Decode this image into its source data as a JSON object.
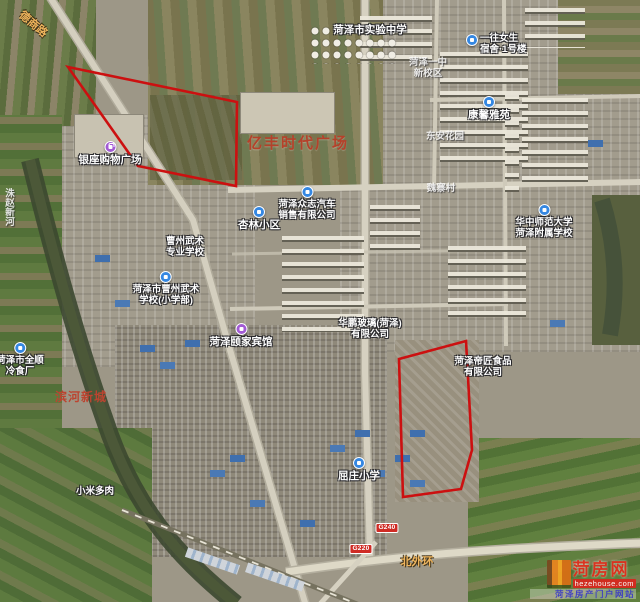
{
  "map": {
    "type": "satellite",
    "city": "菏泽",
    "plot_style": {
      "stroke": "#cc1010",
      "stroke_width": 2.6
    }
  },
  "labels": [
    {
      "name": "shiyan-middle-school",
      "lines": [
        "菏泽市实验中学"
      ],
      "x": 370,
      "y": 24,
      "cls": "lw",
      "interactable": true
    },
    {
      "name": "dorm-building",
      "lines": [
        "一往女生",
        "宿舍·1号楼"
      ],
      "x": 466,
      "y": 33,
      "cls": "lw sm",
      "icon": "blue",
      "iconPos": "left",
      "align": "left",
      "interactable": true
    },
    {
      "name": "heze-no1-middle-school",
      "lines": [
        "菏泽一中",
        "新校区"
      ],
      "x": 428,
      "y": 57,
      "cls": "lf",
      "interactable": true
    },
    {
      "name": "kangxin-yayuan",
      "lines": [
        "康馨雅苑"
      ],
      "x": 489,
      "y": 96,
      "cls": "lw",
      "icon": "blue",
      "iconPos": "top",
      "interactable": true
    },
    {
      "name": "dongan-garden",
      "lines": [
        "东安花园"
      ],
      "x": 445,
      "y": 131,
      "cls": "lf",
      "interactable": true
    },
    {
      "name": "yifeng-times-plaza",
      "lines": [
        "亿丰时代广场"
      ],
      "x": 298,
      "y": 132,
      "cls": "lr-lg",
      "interactable": true
    },
    {
      "name": "yinzuo-shopping-plaza",
      "lines": [
        "银座购物广场"
      ],
      "x": 110,
      "y": 141,
      "cls": "lw",
      "icon": "purple-shop",
      "iconPos": "top",
      "interactable": true
    },
    {
      "name": "zhongzhi-auto-sales",
      "lines": [
        "菏泽众志汽车",
        "销售有限公司"
      ],
      "x": 307,
      "y": 186,
      "cls": "lw sm",
      "icon": "blue",
      "iconPos": "top",
      "interactable": true
    },
    {
      "name": "xinglin-residential",
      "lines": [
        "杏林小区"
      ],
      "x": 259,
      "y": 206,
      "cls": "lw",
      "icon": "blue",
      "iconPos": "top",
      "interactable": true
    },
    {
      "name": "caozhou-martial-arts-school",
      "lines": [
        "曹州武术",
        "专业学校"
      ],
      "x": 185,
      "y": 236,
      "cls": "lw sm",
      "interactable": true
    },
    {
      "name": "martial-arts-primary-school",
      "lines": [
        "菏泽市曹州武术",
        "学校(小学部)"
      ],
      "x": 166,
      "y": 271,
      "cls": "lw sm",
      "icon": "blue",
      "iconPos": "top",
      "interactable": true
    },
    {
      "name": "weizhai-village",
      "lines": [
        "魏寨村"
      ],
      "x": 441,
      "y": 183,
      "cls": "lf",
      "interactable": false
    },
    {
      "name": "huazhong-normal-univ-affiliated-school",
      "lines": [
        "华中师范大学",
        "菏泽附属学校"
      ],
      "x": 544,
      "y": 204,
      "cls": "lw sm",
      "icon": "blue",
      "iconPos": "top",
      "interactable": true
    },
    {
      "name": "huapeng-glass-co",
      "lines": [
        "华鹏玻璃(菏泽)",
        "有限公司"
      ],
      "x": 370,
      "y": 318,
      "cls": "lw sm",
      "interactable": true
    },
    {
      "name": "yijia-hotel",
      "lines": [
        "菏泽颐家宾馆"
      ],
      "x": 241,
      "y": 323,
      "cls": "lw",
      "icon": "purple-hotel",
      "iconPos": "top",
      "interactable": true
    },
    {
      "name": "dijiang-food-co",
      "lines": [
        "菏泽帝匠食品",
        "有限公司"
      ],
      "x": 483,
      "y": 356,
      "cls": "lw sm",
      "interactable": true
    },
    {
      "name": "quanshun-cold-storage",
      "lines": [
        "菏泽市全顺",
        "冷食厂"
      ],
      "x": 20,
      "y": 342,
      "cls": "lw sm",
      "icon": "blue",
      "iconPos": "top",
      "interactable": true
    },
    {
      "name": "binhe-new-town",
      "lines": [
        "滨河新城"
      ],
      "x": 81,
      "y": 388,
      "cls": "lr-md",
      "interactable": true
    },
    {
      "name": "xiaomi-succulents",
      "lines": [
        "小米多肉"
      ],
      "x": 95,
      "y": 486,
      "cls": "lw sm",
      "interactable": true
    },
    {
      "name": "quzhuang-primary-school",
      "lines": [
        "屈庄小学"
      ],
      "x": 359,
      "y": 457,
      "cls": "lw",
      "icon": "blue",
      "iconPos": "top",
      "interactable": true
    },
    {
      "name": "north-outer-ring-road",
      "lines": [
        "北外环"
      ],
      "x": 417,
      "y": 553,
      "cls": "lroad",
      "interactable": false
    },
    {
      "name": "deshang-road",
      "lines": [
        "德商路"
      ],
      "x": 40,
      "y": 10,
      "cls": "lroad sm",
      "rot": 40,
      "interactable": false
    },
    {
      "name": "zhuzhao-new-river",
      "lines": [
        "洙赵新河"
      ],
      "x": 3,
      "y": 188,
      "cls": "lf",
      "vertical": true,
      "align": "left",
      "interactable": false
    }
  ],
  "road_badges": [
    {
      "text": "G240",
      "x": 387,
      "y": 523
    },
    {
      "text": "G220",
      "x": 361,
      "y": 544
    }
  ],
  "plots": [
    {
      "name": "highlighted-plot-northwest",
      "points": [
        [
          68,
          67
        ],
        [
          237,
          102
        ],
        [
          236,
          186
        ],
        [
          138,
          166
        ]
      ]
    },
    {
      "name": "highlighted-plot-southeast",
      "points": [
        [
          399,
          359
        ],
        [
          466,
          341
        ],
        [
          472,
          450
        ],
        [
          461,
          489
        ],
        [
          403,
          497
        ]
      ]
    }
  ],
  "watermark": {
    "site_name": "菏房网",
    "domain": "hezehouse.com",
    "tagline": "菏泽房产门户网站"
  }
}
